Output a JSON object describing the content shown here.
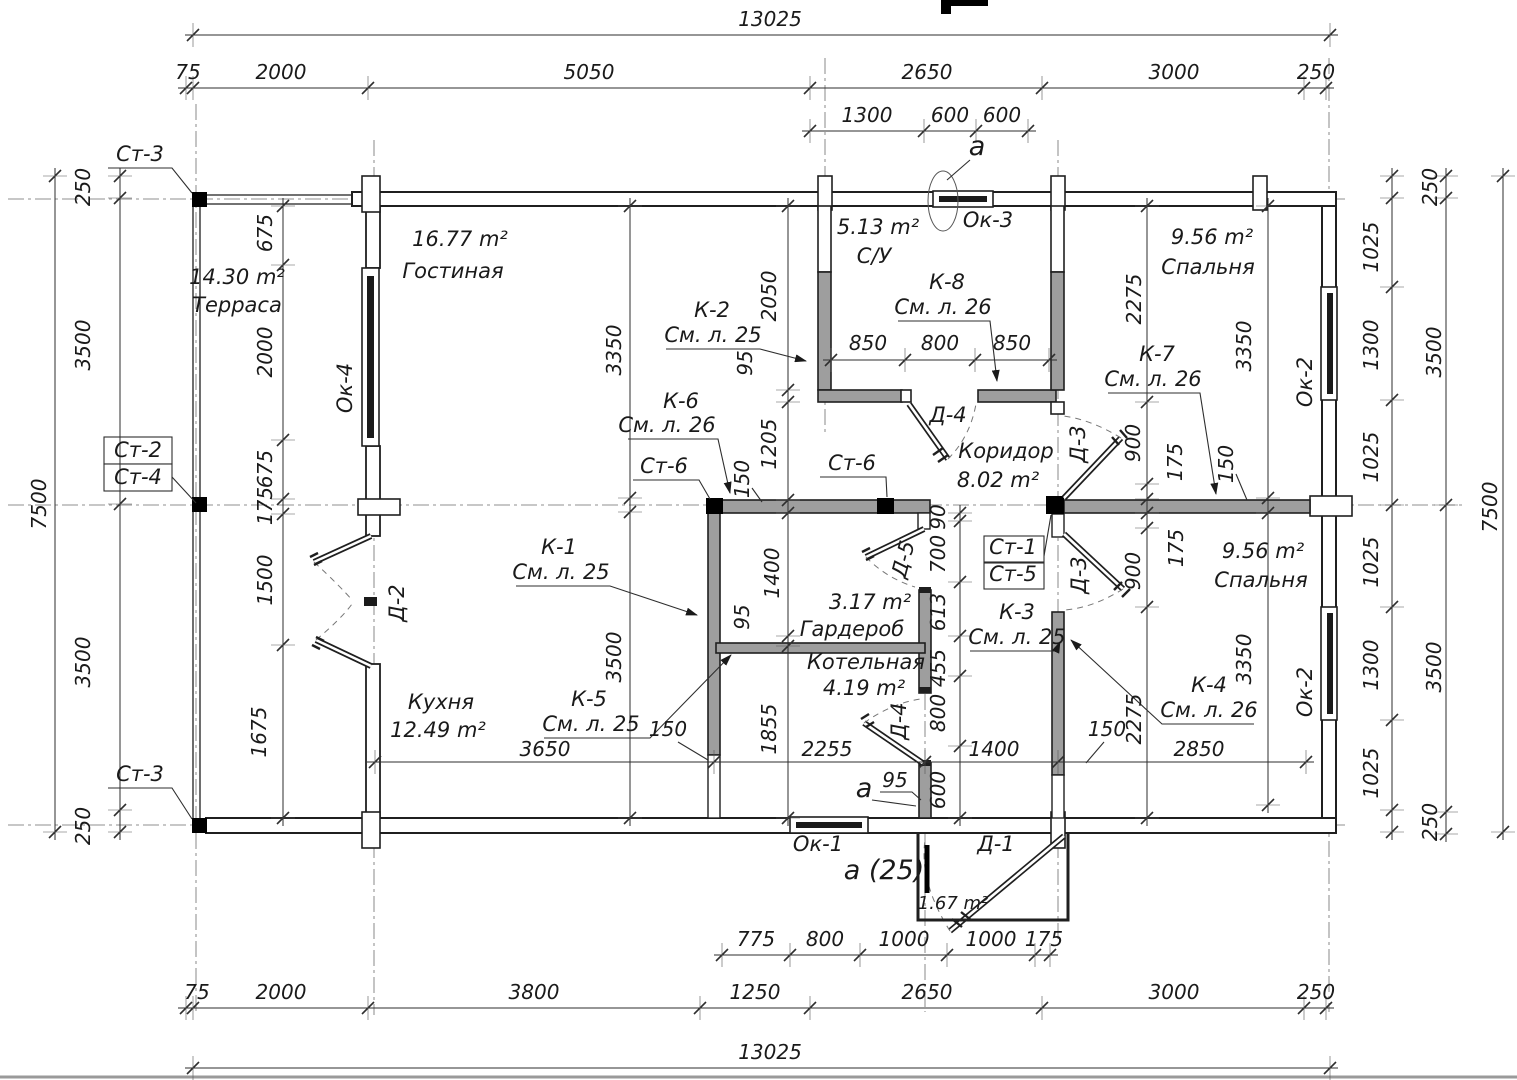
{
  "meta": {
    "drawing_type": "floor-plan",
    "units": "mm"
  },
  "colors": {
    "line": "#1f1f1f",
    "partition_fill": "#9e9e9e",
    "column_fill": "#000000",
    "dim_line": "#2e2e2e",
    "background": "#ffffff"
  },
  "texts": {
    "dims_top": [
      {
        "t": "13025",
        "x": 770,
        "y": 26,
        "n": "dim-overall-top"
      },
      {
        "t": "75",
        "x": 188,
        "y": 79
      },
      {
        "t": "2000",
        "x": 281,
        "y": 79
      },
      {
        "t": "5050",
        "x": 589,
        "y": 79
      },
      {
        "t": "2650",
        "x": 927,
        "y": 79
      },
      {
        "t": "3000",
        "x": 1174,
        "y": 79
      },
      {
        "t": "250",
        "x": 1316,
        "y": 79
      },
      {
        "t": "1300",
        "x": 867,
        "y": 122
      },
      {
        "t": "600",
        "x": 950,
        "y": 122
      },
      {
        "t": "600",
        "x": 1002,
        "y": 122
      }
    ],
    "dims_bottom": [
      {
        "t": "775",
        "x": 756,
        "y": 946
      },
      {
        "t": "800",
        "x": 825,
        "y": 946
      },
      {
        "t": "1000",
        "x": 904,
        "y": 946
      },
      {
        "t": "1000",
        "x": 991,
        "y": 946
      },
      {
        "t": "175",
        "x": 1044,
        "y": 946
      },
      {
        "t": "75",
        "x": 197,
        "y": 999
      },
      {
        "t": "2000",
        "x": 281,
        "y": 999
      },
      {
        "t": "3800",
        "x": 534,
        "y": 999
      },
      {
        "t": "1250",
        "x": 755,
        "y": 999
      },
      {
        "t": "2650",
        "x": 927,
        "y": 999
      },
      {
        "t": "3000",
        "x": 1174,
        "y": 999
      },
      {
        "t": "250",
        "x": 1316,
        "y": 999
      },
      {
        "t": "13025",
        "x": 770,
        "y": 1059,
        "n": "dim-overall-bottom"
      }
    ],
    "dims_left": [
      {
        "t": "7500",
        "x": 46,
        "y": 504,
        "r": -90
      },
      {
        "t": "250",
        "x": 90,
        "y": 187,
        "r": -90
      },
      {
        "t": "3500",
        "x": 90,
        "y": 345,
        "r": -90
      },
      {
        "t": "3500",
        "x": 90,
        "y": 662,
        "r": -90
      },
      {
        "t": "250",
        "x": 90,
        "y": 826,
        "r": -90
      },
      {
        "t": "675",
        "x": 272,
        "y": 233,
        "r": -90
      },
      {
        "t": "2000",
        "x": 272,
        "y": 352,
        "r": -90
      },
      {
        "t": "675",
        "x": 272,
        "y": 469,
        "r": -90
      },
      {
        "t": "175",
        "x": 272,
        "y": 506,
        "r": -90
      },
      {
        "t": "1500",
        "x": 272,
        "y": 580,
        "r": -90
      },
      {
        "t": "1675",
        "x": 266,
        "y": 732,
        "r": -90
      }
    ],
    "dims_right": [
      {
        "t": "250",
        "x": 1437,
        "y": 187,
        "r": -90
      },
      {
        "t": "1025",
        "x": 1378,
        "y": 247,
        "r": -90
      },
      {
        "t": "1300",
        "x": 1378,
        "y": 345,
        "r": -90
      },
      {
        "t": "1025",
        "x": 1378,
        "y": 457,
        "r": -90
      },
      {
        "t": "1025",
        "x": 1378,
        "y": 562,
        "r": -90
      },
      {
        "t": "1300",
        "x": 1378,
        "y": 665,
        "r": -90
      },
      {
        "t": "1025",
        "x": 1378,
        "y": 773,
        "r": -90
      },
      {
        "t": "250",
        "x": 1437,
        "y": 822,
        "r": -90
      },
      {
        "t": "3500",
        "x": 1441,
        "y": 352,
        "r": -90
      },
      {
        "t": "3500",
        "x": 1441,
        "y": 667,
        "r": -90
      },
      {
        "t": "7500",
        "x": 1497,
        "y": 507,
        "r": -90
      }
    ],
    "dims_inner": [
      {
        "t": "2050",
        "x": 776,
        "y": 296,
        "r": -90
      },
      {
        "t": "95",
        "x": 752,
        "y": 363,
        "r": -90
      },
      {
        "t": "1205",
        "x": 776,
        "y": 444,
        "r": -90
      },
      {
        "t": "150",
        "x": 749,
        "y": 479,
        "r": -90
      },
      {
        "t": "3350",
        "x": 621,
        "y": 350,
        "r": -90
      },
      {
        "t": "3500",
        "x": 621,
        "y": 657,
        "r": -90
      },
      {
        "t": "1400",
        "x": 779,
        "y": 573,
        "r": -90
      },
      {
        "t": "95",
        "x": 749,
        "y": 617,
        "r": -90
      },
      {
        "t": "1855",
        "x": 776,
        "y": 729,
        "r": -90
      },
      {
        "t": "2275",
        "x": 1141,
        "y": 299,
        "r": -90
      },
      {
        "t": "900",
        "x": 1140,
        "y": 443,
        "r": -90
      },
      {
        "t": "175",
        "x": 1182,
        "y": 462,
        "r": -90
      },
      {
        "t": "150",
        "x": 1233,
        "y": 464,
        "r": -90
      },
      {
        "t": "175",
        "x": 1183,
        "y": 548,
        "r": -90
      },
      {
        "t": "900",
        "x": 1140,
        "y": 571,
        "r": -90
      },
      {
        "t": "2275",
        "x": 1141,
        "y": 719,
        "r": -90
      },
      {
        "t": "3350",
        "x": 1251,
        "y": 346,
        "r": -90
      },
      {
        "t": "3350",
        "x": 1251,
        "y": 659,
        "r": -90
      },
      {
        "t": "90",
        "x": 945,
        "y": 517,
        "r": -90
      },
      {
        "t": "700",
        "x": 945,
        "y": 554,
        "r": -90
      },
      {
        "t": "613",
        "x": 945,
        "y": 612,
        "r": -90
      },
      {
        "t": "455",
        "x": 945,
        "y": 668,
        "r": -90
      },
      {
        "t": "800",
        "x": 945,
        "y": 713,
        "r": -90
      },
      {
        "t": "600",
        "x": 945,
        "y": 790,
        "r": -90
      },
      {
        "t": "850",
        "x": 868,
        "y": 350
      },
      {
        "t": "800",
        "x": 940,
        "y": 350
      },
      {
        "t": "850",
        "x": 1012,
        "y": 350
      },
      {
        "t": "3650",
        "x": 545,
        "y": 756
      },
      {
        "t": "2255",
        "x": 827,
        "y": 756
      },
      {
        "t": "1400",
        "x": 994,
        "y": 756
      },
      {
        "t": "2850",
        "x": 1199,
        "y": 756
      },
      {
        "t": "150",
        "x": 668,
        "y": 736
      },
      {
        "t": "150",
        "x": 1107,
        "y": 736
      },
      {
        "t": "95",
        "x": 895,
        "y": 787
      }
    ],
    "rooms": [
      {
        "t": "14.30 m²",
        "x": 237,
        "y": 284,
        "n": "room-terrace-area"
      },
      {
        "t": "Терраса",
        "x": 237,
        "y": 312,
        "n": "room-terrace-name"
      },
      {
        "t": "16.77 m²",
        "x": 460,
        "y": 246,
        "n": "room-living-area"
      },
      {
        "t": "Гостиная",
        "x": 453,
        "y": 278,
        "n": "room-living-name"
      },
      {
        "t": "5.13 m²",
        "x": 878,
        "y": 234,
        "n": "room-wc-area"
      },
      {
        "t": "С/У",
        "x": 874,
        "y": 263,
        "n": "room-wc-name"
      },
      {
        "t": "9.56 m²",
        "x": 1212,
        "y": 244,
        "n": "room-bedroom1-area"
      },
      {
        "t": "Спальня",
        "x": 1208,
        "y": 274,
        "n": "room-bedroom1-name"
      },
      {
        "t": "Коридор",
        "x": 1006,
        "y": 458,
        "n": "room-corridor-name"
      },
      {
        "t": "8.02 m²",
        "x": 998,
        "y": 487,
        "n": "room-corridor-area"
      },
      {
        "t": "3.17 m²",
        "x": 870,
        "y": 609,
        "n": "room-wardrobe-area"
      },
      {
        "t": "Гардероб",
        "x": 852,
        "y": 636,
        "n": "room-wardrobe-name"
      },
      {
        "t": "Котельная",
        "x": 866,
        "y": 669,
        "n": "room-boiler-name"
      },
      {
        "t": "4.19 m²",
        "x": 864,
        "y": 695,
        "n": "room-boiler-area"
      },
      {
        "t": "Кухня",
        "x": 441,
        "y": 709,
        "n": "room-kitchen-name"
      },
      {
        "t": "12.49 m²",
        "x": 438,
        "y": 737,
        "n": "room-kitchen-area"
      },
      {
        "t": "9.56 m²",
        "x": 1263,
        "y": 558,
        "n": "room-bedroom2-area"
      },
      {
        "t": "Спальня",
        "x": 1261,
        "y": 587,
        "n": "room-bedroom2-name"
      },
      {
        "t": "1.67 m²",
        "x": 953,
        "y": 909,
        "s": 18,
        "n": "room-porch-area"
      }
    ],
    "windows": [
      {
        "t": "Ок-4",
        "x": 352,
        "y": 388,
        "r": -90,
        "n": "window-ok4-label"
      },
      {
        "t": "Ок-3",
        "x": 988,
        "y": 227,
        "n": "window-ok3-label"
      },
      {
        "t": "Ок-2",
        "x": 1312,
        "y": 382,
        "r": -90,
        "n": "window-ok2-top-label"
      },
      {
        "t": "Ок-2",
        "x": 1312,
        "y": 692,
        "r": -90,
        "n": "window-ok2-bottom-label"
      },
      {
        "t": "Ок-1",
        "x": 818,
        "y": 851,
        "n": "window-ok1-label"
      }
    ],
    "doors": [
      {
        "t": "Д-2",
        "x": 404,
        "y": 603,
        "r": -90,
        "n": "door-d2-label"
      },
      {
        "t": "Д-4",
        "x": 948,
        "y": 422,
        "n": "door-d4-top-label"
      },
      {
        "t": "Д-5",
        "x": 910,
        "y": 561,
        "r": -75,
        "n": "door-d5-label"
      },
      {
        "t": "Д-3",
        "x": 1085,
        "y": 444,
        "r": -90,
        "n": "door-d3-top-label"
      },
      {
        "t": "Д-3",
        "x": 1086,
        "y": 575,
        "r": -90,
        "n": "door-d3-bottom-label"
      },
      {
        "t": "Д-4",
        "x": 906,
        "y": 721,
        "r": -90,
        "n": "door-d4-bottom-label"
      },
      {
        "t": "Д-1",
        "x": 996,
        "y": 851,
        "n": "door-d1-label"
      }
    ],
    "columns": [
      {
        "t": "Ст-3",
        "x": 140,
        "y": 161,
        "n": "column-st3-top-label"
      },
      {
        "t": "Ст-2",
        "x": 138,
        "y": 457,
        "n": "column-st2-label"
      },
      {
        "t": "Ст-4",
        "x": 138,
        "y": 484,
        "n": "column-st4-label"
      },
      {
        "t": "Ст-3",
        "x": 140,
        "y": 781,
        "n": "column-st3-bottom-label"
      },
      {
        "t": "Ст-6",
        "x": 664,
        "y": 473,
        "n": "column-st6-left-label"
      },
      {
        "t": "Ст-6",
        "x": 852,
        "y": 470,
        "n": "column-st6-right-label"
      },
      {
        "t": "Ст-1",
        "x": 1013,
        "y": 554,
        "n": "column-st1-label"
      },
      {
        "t": "Ст-5",
        "x": 1013,
        "y": 581,
        "n": "column-st5-label"
      }
    ],
    "constructions": [
      {
        "t": "К-2",
        "x": 712,
        "y": 317,
        "n": "construction-k2-label"
      },
      {
        "t": "См. л. 25",
        "x": 713,
        "y": 342,
        "n": "construction-k2-ref"
      },
      {
        "t": "К-8",
        "x": 947,
        "y": 289,
        "n": "construction-k8-label"
      },
      {
        "t": "См. л. 26",
        "x": 943,
        "y": 314,
        "n": "construction-k8-ref"
      },
      {
        "t": "К-7",
        "x": 1157,
        "y": 361,
        "n": "construction-k7-label"
      },
      {
        "t": "См. л. 26",
        "x": 1153,
        "y": 386,
        "n": "construction-k7-ref"
      },
      {
        "t": "К-6",
        "x": 681,
        "y": 408,
        "n": "construction-k6-label"
      },
      {
        "t": "См. л. 26",
        "x": 667,
        "y": 432,
        "n": "construction-k6-ref"
      },
      {
        "t": "К-1",
        "x": 559,
        "y": 554,
        "n": "construction-k1-label"
      },
      {
        "t": "См. л. 25",
        "x": 561,
        "y": 579,
        "n": "construction-k1-ref"
      },
      {
        "t": "К-5",
        "x": 589,
        "y": 706,
        "n": "construction-k5-label"
      },
      {
        "t": "См. л. 25",
        "x": 591,
        "y": 731,
        "n": "construction-k5-ref"
      },
      {
        "t": "К-3",
        "x": 1017,
        "y": 619,
        "n": "construction-k3-label"
      },
      {
        "t": "См. л. 25",
        "x": 1017,
        "y": 644,
        "n": "construction-k3-ref"
      },
      {
        "t": "К-4",
        "x": 1209,
        "y": 692,
        "n": "construction-k4-label"
      },
      {
        "t": "См. л. 26",
        "x": 1209,
        "y": 717,
        "n": "construction-k4-ref"
      }
    ],
    "sections": [
      {
        "t": "а",
        "x": 977,
        "y": 155,
        "s": 27,
        "n": "section-mark-a-top"
      },
      {
        "t": "а",
        "x": 864,
        "y": 797,
        "s": 27,
        "n": "section-mark-a-bottom"
      },
      {
        "t": "а (25)",
        "x": 884,
        "y": 879,
        "s": 27,
        "n": "section-mark-a25"
      }
    ]
  }
}
